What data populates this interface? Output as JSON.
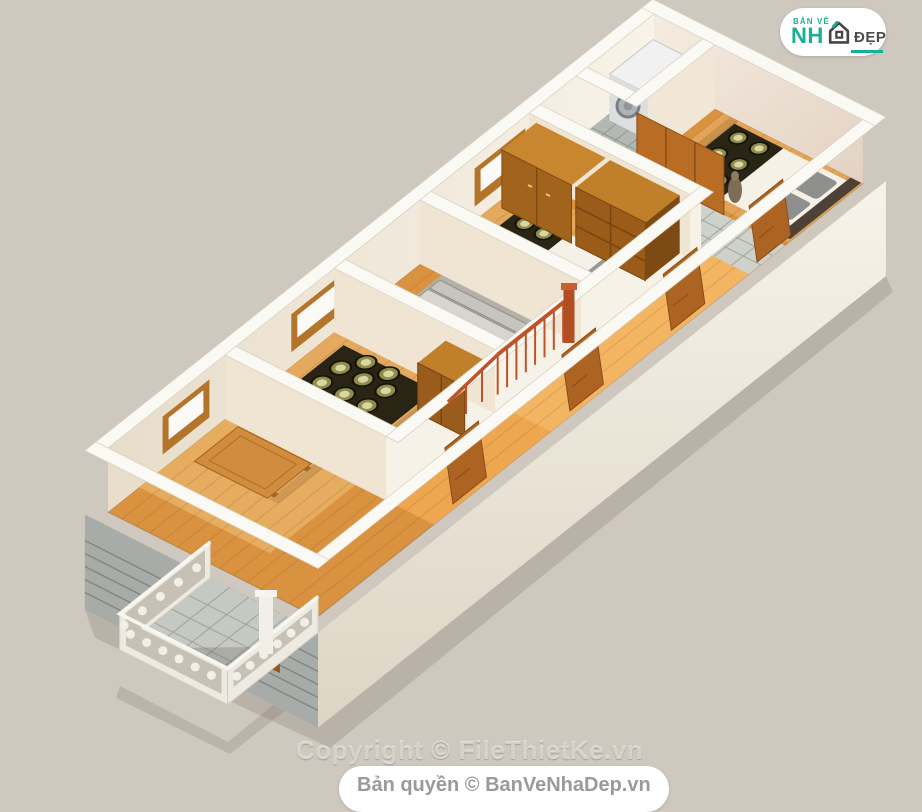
{
  "logo": {
    "top_label": "BẢN VẼ",
    "main_label": "NH",
    "suffix_label": "ĐẸP",
    "icon": "house-icon",
    "accent_color": "#17b094",
    "dark_color": "#4c4c4c"
  },
  "watermark": {
    "text": "Copyright © FileThietKe.vn"
  },
  "footer": {
    "text": "Bản quyền © BanVeNhaDep.vn",
    "text_color": "#9a9a9a"
  },
  "palette": {
    "background": "#cfc8bf",
    "wall_white": "#fbf9f4",
    "wall_cream": "#f2e9da",
    "wood_floor": "#d9923f",
    "wood_furniture": "#b06a26",
    "tile_gray": "#ced2cb",
    "railing_orange": "#c05227",
    "blanket_dark": "#2a2414",
    "rosette_olive": "#8f8d49",
    "siding_gray": "#a7aca9"
  }
}
